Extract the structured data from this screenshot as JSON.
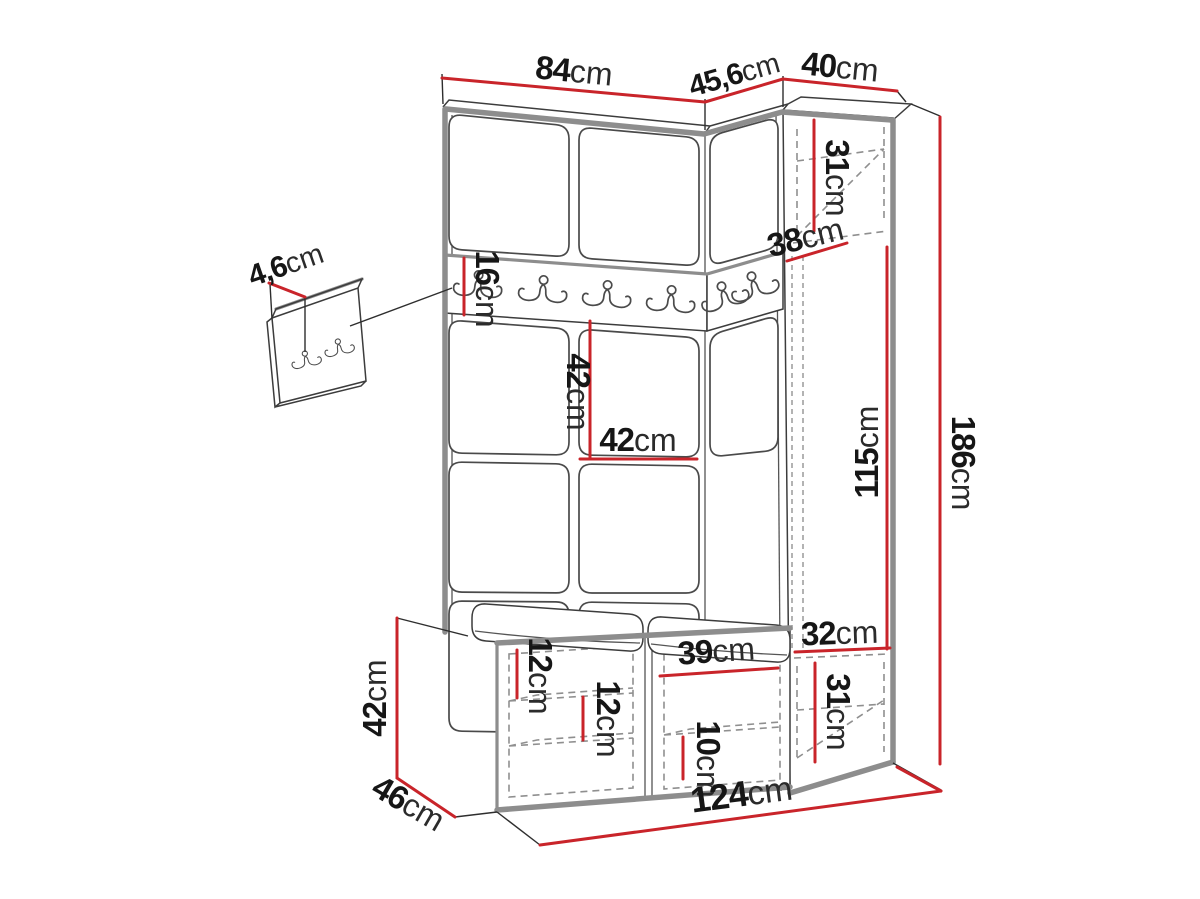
{
  "diagram": {
    "type": "furniture-dimension-drawing",
    "unit": "cm",
    "accent_color": "#c9242a",
    "dims": {
      "top_width_left": {
        "value": "84",
        "unit": "cm"
      },
      "top_width_corner": {
        "value": "45,6",
        "unit": "cm"
      },
      "top_width_right": {
        "value": "40",
        "unit": "cm"
      },
      "wardrobe_top_compartment": {
        "value": "31",
        "unit": "cm"
      },
      "wardrobe_interior_depth": {
        "value": "38",
        "unit": "cm"
      },
      "wardrobe_door_height": {
        "value": "115",
        "unit": "cm"
      },
      "total_height": {
        "value": "186",
        "unit": "cm"
      },
      "hook_rail_height": {
        "value": "16",
        "unit": "cm"
      },
      "panel_height": {
        "value": "42",
        "unit": "cm"
      },
      "panel_width": {
        "value": "42",
        "unit": "cm"
      },
      "small_panel_thickness": {
        "value": "4,6",
        "unit": "cm"
      },
      "bench_height": {
        "value": "42",
        "unit": "cm"
      },
      "bench_depth": {
        "value": "46",
        "unit": "cm"
      },
      "bench_shelf_offset": {
        "value": "12",
        "unit": "cm"
      },
      "bench_shelf_spacing": {
        "value": "12",
        "unit": "cm"
      },
      "bench_right_width": {
        "value": "39",
        "unit": "cm"
      },
      "bench_right_shelf": {
        "value": "10",
        "unit": "cm"
      },
      "wardrobe_bottom_shelf": {
        "value": "32",
        "unit": "cm"
      },
      "wardrobe_bottom_compartment": {
        "value": "31",
        "unit": "cm"
      },
      "total_width": {
        "value": "124",
        "unit": "cm"
      }
    },
    "icons": {
      "hook_icon": "double-coat-hook",
      "rail_hook_count": 6,
      "small_panel_hook_count": 2
    }
  }
}
